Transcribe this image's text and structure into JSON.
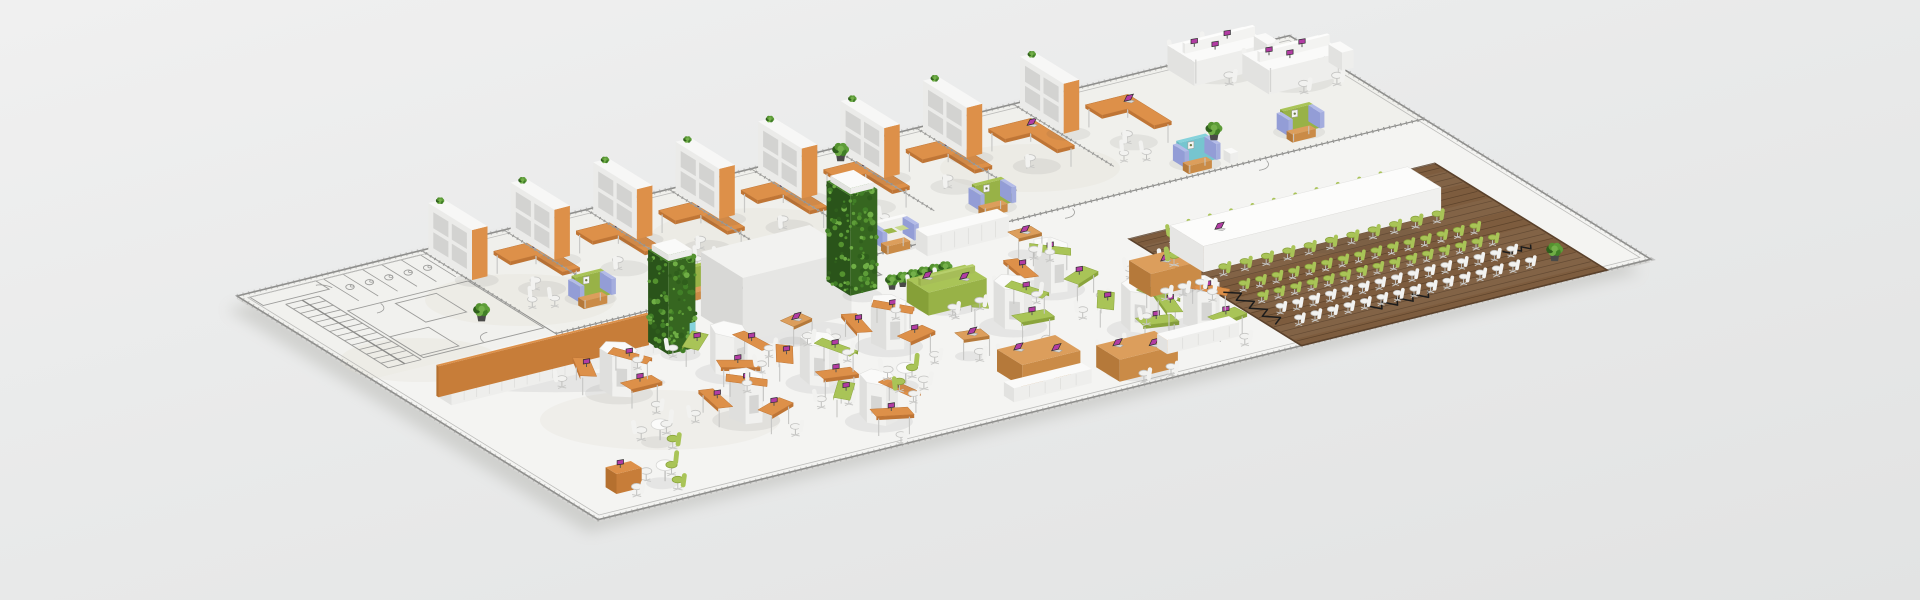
{
  "alt": "3D isometric rendering of a long open-plan office floor plate on a light gray background: CAD-drawn service rooms and stairs at the left, a row of private offices with orange L-shaped desks, tall orange-trimmed bookcases and lounge sofas along the back, honeycomb desk pods with orange and green worktops in the front open area, green plant-wall towers, white storage cabinets, wooden bench desks, and a conference zone on dark wood flooring with a long white table and rows of green and white chairs",
  "palette": {
    "floor": "#f4f4f2",
    "backFloor": "#f0efeb",
    "cadFloor": "#f1f1ee",
    "wall": "#8e8e8c",
    "line": "#9c9c9a",
    "slab": "#d6d6d4",
    "orange": "#dd9049",
    "orangeDark": "#bf7535",
    "green": "#a9c457",
    "greenDark": "#8aa43c",
    "cushionGreen": "#9cb84a",
    "teal": "#85d2db",
    "tealDark": "#66b7c2",
    "magenta": "#b23ca3",
    "chairWhite": "#f2f2f0",
    "chairStroke": "#c4c4c2",
    "leafDots": [
      "#5d9c38",
      "#417f27",
      "#6fae45",
      "#2f5e1c",
      "#54922f"
    ],
    "leafLight": "#74b04a",
    "woodFloor": "#7d5c3e",
    "plankLine": "rgba(58,39,22,0.45)",
    "woodFrame": "#5a412b",
    "matWhite": {
      "t": "#fafaf9",
      "w": "#e2e2e0",
      "s": "#eeeeec",
      "st": "#deded c"
    },
    "matCore": {
      "t": "#f2f2f0",
      "w": "#d8d8d6",
      "s": "#e6e6e4"
    },
    "matLeaf": {
      "t": "#45812a",
      "w": "#2a541a",
      "s": "#366620"
    },
    "matLav": {
      "t": "#b3bbe8",
      "w": "#939dd6",
      "s": "#a4adde"
    },
    "matWood": {
      "t": "#dc9e5c",
      "w": "#b5793a",
      "s": "#ca8b47"
    },
    "matOrange": {
      "t": "#dd9049",
      "w": "#b5702f",
      "s": "#c77d39"
    },
    "matGreen": {
      "t": "#a9c457",
      "w": "#86a038",
      "s": "#98b247"
    }
  },
  "scene": {
    "projection": {
      "origin": [
        237,
        296
      ],
      "u": [
        0.97,
        -0.24
      ],
      "v": [
        0.84,
        0.52
      ]
    },
    "plate": {
      "length": 1085,
      "depth": 430,
      "backBandDepth": 160
    },
    "blotches": [
      [
        520,
        300,
        95,
        26
      ],
      [
        760,
        238,
        110,
        30
      ],
      [
        1030,
        168,
        90,
        24
      ],
      [
        660,
        420,
        120,
        30
      ],
      [
        420,
        360,
        80,
        22
      ]
    ],
    "cad": {
      "stair": {
        "u0": 26,
        "v0": 28,
        "u1": 60,
        "v1": 150,
        "steps": 14
      },
      "stalls": {
        "u0": 84,
        "step": 20,
        "n": 6,
        "v0": 6,
        "v1": 48
      },
      "toilets": {
        "u0": 94,
        "step": 20,
        "n": 5,
        "v": 26
      },
      "rooms": [
        [
          64,
          58,
          188,
          148
        ],
        [
          8,
          6,
          76,
          22
        ],
        [
          108,
          64,
          150,
          100
        ],
        [
          64,
          108,
          104,
          144
        ]
      ],
      "arcs": [
        [
          84,
          58,
          13,
          5,
          95
        ],
        [
          140,
          148,
          13,
          185,
          275
        ],
        [
          70,
          22,
          10,
          275,
          355
        ]
      ]
    },
    "atrium": {
      "u0": 432,
      "v0": 162,
      "u1": 500,
      "v1": 190
    },
    "doorArcs": [
      [
        240,
        160,
        15
      ],
      [
        475,
        160,
        15
      ],
      [
        705,
        160,
        15
      ],
      [
        905,
        160,
        15
      ]
    ],
    "offices": {
      "wallTop": 120,
      "cells": [
        {
          "u": 190,
          "guest": true
        },
        {
          "u": 275,
          "guest": false
        },
        {
          "u": 360,
          "guest": true
        },
        {
          "u": 445,
          "guest": false
        },
        {
          "u": 530,
          "guest": true
        },
        {
          "u": 615,
          "guest": false
        },
        {
          "u": 700,
          "guest": false
        },
        {
          "u": 800,
          "guest": true
        }
      ]
    },
    "lounges": [
      {
        "u": 248,
        "v": 112,
        "type": "green"
      },
      {
        "u": 332,
        "v": 138,
        "type": "green"
      },
      {
        "u": 536,
        "v": 140,
        "type": "whiteGreen"
      },
      {
        "u": 652,
        "v": 122,
        "type": "green"
      },
      {
        "u": 854,
        "v": 132,
        "type": "teal"
      },
      {
        "u": 968,
        "v": 124,
        "type": "green"
      }
    ],
    "whiteBenches": [
      {
        "u": 955,
        "v": 5
      },
      {
        "u": 1000,
        "v": 42
      }
    ],
    "cabinetRow": {
      "u0": 28,
      "v0": 205,
      "u1": 245,
      "v1": 223,
      "h": 26
    },
    "lowCabinet": {
      "u0": 556,
      "v0": 166,
      "u1": 640,
      "v1": 180,
      "h": 20
    },
    "towers": [
      {
        "u0": 248,
        "v0": 203,
        "u1": 276,
        "v1": 227,
        "h": 92,
        "teal": true
      },
      {
        "u0": 452,
        "v0": 180,
        "u1": 480,
        "v1": 208,
        "h": 100,
        "teal": false
      }
    ],
    "core": {
      "u0": 318,
      "v0": 185,
      "u1": 430,
      "v1": 235,
      "h": 64
    },
    "potRow": {
      "u": 490,
      "v": 214,
      "n": 6,
      "step": 11
    },
    "pods": [
      {
        "u": 170,
        "v": 258,
        "rot": 0,
        "c": [
          "o",
          "o",
          "o"
        ]
      },
      {
        "u": 275,
        "v": 268,
        "rot": 25,
        "c": [
          "o",
          "g",
          "o"
        ]
      },
      {
        "u": 232,
        "v": 338,
        "rot": -18,
        "c": [
          "o",
          "o",
          "o"
        ]
      },
      {
        "u": 330,
        "v": 312,
        "rot": 10,
        "c": [
          "o",
          "o",
          "g"
        ]
      },
      {
        "u": 425,
        "v": 285,
        "rot": -12,
        "c": [
          "o",
          "o",
          "o"
        ]
      },
      {
        "u": 328,
        "v": 385,
        "rot": 18,
        "c": [
          "o",
          "g",
          "o"
        ]
      },
      {
        "u": 540,
        "v": 300,
        "rot": 5,
        "c": [
          "g",
          "g",
          "g"
        ]
      },
      {
        "u": 612,
        "v": 262,
        "rot": -20,
        "c": [
          "g",
          "o",
          "g"
        ]
      },
      {
        "u": 630,
        "v": 348,
        "rot": 12,
        "c": [
          "g",
          "g",
          "g"
        ]
      },
      {
        "u": 678,
        "v": 365,
        "rot": -8,
        "c": [
          "g",
          "g",
          "o"
        ]
      }
    ],
    "roundTables": [
      {
        "u": 388,
        "v": 348,
        "chairs": [
          "g",
          "w",
          "g",
          "w"
        ]
      },
      {
        "u": 140,
        "v": 342,
        "chairs": [
          "w",
          "g",
          "w"
        ]
      },
      {
        "u": 95,
        "v": 400,
        "chairs": [
          "g",
          "g",
          "w"
        ]
      }
    ],
    "singles": [
      {
        "u": 360,
        "v": 250,
        "rot": -12
      },
      {
        "u": 472,
        "v": 330,
        "rot": 8
      },
      {
        "u": 632,
        "v": 208,
        "rot": 0
      }
    ],
    "meetingTable": {
      "u0": 672,
      "v0": 286,
      "u1": 724,
      "v1": 312
    },
    "greenBench": {
      "u0": 486,
      "v0": 236,
      "u1": 546,
      "v1": 262
    },
    "woodBenches": [
      {
        "u0": 470,
        "v0": 362,
        "u1": 530,
        "v1": 392
      },
      {
        "u0": 548,
        "v0": 390,
        "u1": 608,
        "v1": 418
      }
    ],
    "credenzas": [
      {
        "u0": 446,
        "v0": 398,
        "u1": 526,
        "v1": 410
      },
      {
        "u0": 616,
        "v0": 384,
        "u1": 690,
        "v1": 396
      }
    ],
    "cornerDesk": {
      "u": 44,
      "v": 388
    },
    "floorPlants": [
      {
        "u": 150,
        "v": 118
      },
      {
        "u": 605,
        "v": 20
      },
      {
        "u": 905,
        "v": 118
      }
    ],
    "conference": {
      "wood": {
        "u0": 725,
        "v0": 225,
        "u1": 1040,
        "v1": 430
      },
      "plankStep": 9,
      "table": {
        "u0": 740,
        "v0": 256,
        "u1": 985,
        "v1": 296,
        "h": 26
      },
      "sideChairs": {
        "n": 11,
        "u0": 752,
        "step": 22,
        "vN": 246,
        "vS": 306
      },
      "endChair": {
        "u": 727,
        "v": 276
      },
      "rows": [
        {
          "v": 334,
          "color": "green"
        },
        {
          "v": 356,
          "color": "green"
        },
        {
          "v": 378,
          "color": "white"
        },
        {
          "v": 400,
          "color": "white"
        }
      ],
      "rowChairs": {
        "n": 15,
        "u0": 748,
        "step": 17
      },
      "laptop": {
        "u": 772,
        "v": 278
      },
      "zigzags": [
        {
          "axis": "v",
          "u": 737,
          "v0": 330,
          "v1": 392,
          "amp": 6,
          "n": 8
        },
        {
          "axis": "u",
          "u0": 820,
          "u1": 884,
          "v": 402,
          "amp": 5,
          "n": 8
        },
        {
          "axis": "u",
          "u0": 985,
          "u1": 1014,
          "v": 372,
          "amp": 3,
          "n": 6
        }
      ],
      "plant": {
        "u": 1012,
        "v": 400
      }
    }
  }
}
